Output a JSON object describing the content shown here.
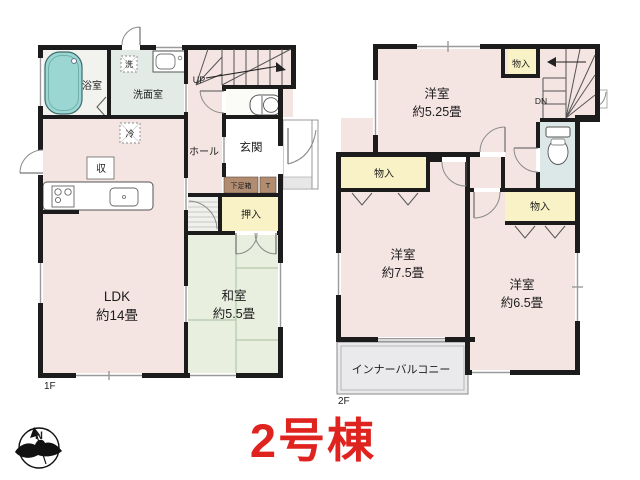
{
  "title": {
    "text": "2号棟",
    "color": "#df2420"
  },
  "compass": {
    "north_label": "N"
  },
  "colors": {
    "accent_red": "#df2420",
    "wall": "#1c1c1c",
    "room_pink": "#f4e4e2",
    "tatami_green": "#e9efdf",
    "closet_yellow": "#f8f2c6",
    "washroom_green": "#e3ebe6",
    "toilet_blue": "#dce8e7",
    "tub_teal": "#9bd6d2",
    "balcony_grey": "#eaeaec",
    "shoebox_brown": "#b28c70"
  },
  "floor1": {
    "label": "1F",
    "bathroom": "浴室",
    "washer": "洗",
    "washroom": "洗面室",
    "fridge": "冷",
    "storage": "収",
    "ldk_name": "LDK",
    "ldk_size": "約14畳",
    "hall": "ホール",
    "stairs_up": "UP",
    "entrance": "玄関",
    "shoe_box": "下足箱",
    "toilet_mark": "T",
    "closet": "押入",
    "washitsu_name": "和室",
    "washitsu_size": "約5.5畳"
  },
  "floor2": {
    "label": "2F",
    "bedroom1_name": "洋室",
    "bedroom1_size": "約5.25畳",
    "closet_top": "物入",
    "stairs_down": "DN",
    "closet_left": "物入",
    "closet_right": "物入",
    "bedroom2_name": "洋室",
    "bedroom2_size": "約7.5畳",
    "bedroom3_name": "洋室",
    "bedroom3_size": "約6.5畳",
    "balcony": "インナーバルコニー"
  }
}
